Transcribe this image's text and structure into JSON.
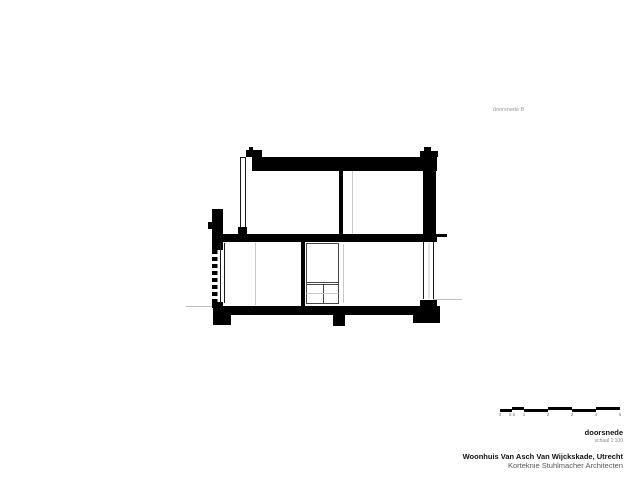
{
  "colors": {
    "background": "#ffffff",
    "ink": "#000000",
    "window_line": "#1a1a1a",
    "detail_line": "#474747",
    "faint_line": "#c8c8c8",
    "muted_label": "#9a9a9a",
    "secondary_text": "#555555"
  },
  "drawing": {
    "label": "doorsnede B",
    "type": "building-section"
  },
  "scalebar": {
    "unit_labels": [
      "0",
      "0.5",
      "1",
      "2",
      "3",
      "4",
      "5"
    ]
  },
  "titleblock": {
    "drawing_title": "doorsnede",
    "scale": "schaal 1:100",
    "project": "Woonhuis Van Asch Van Wijckskade, Utrecht",
    "architect": "Korteknie Stuhlmacher Architecten"
  }
}
